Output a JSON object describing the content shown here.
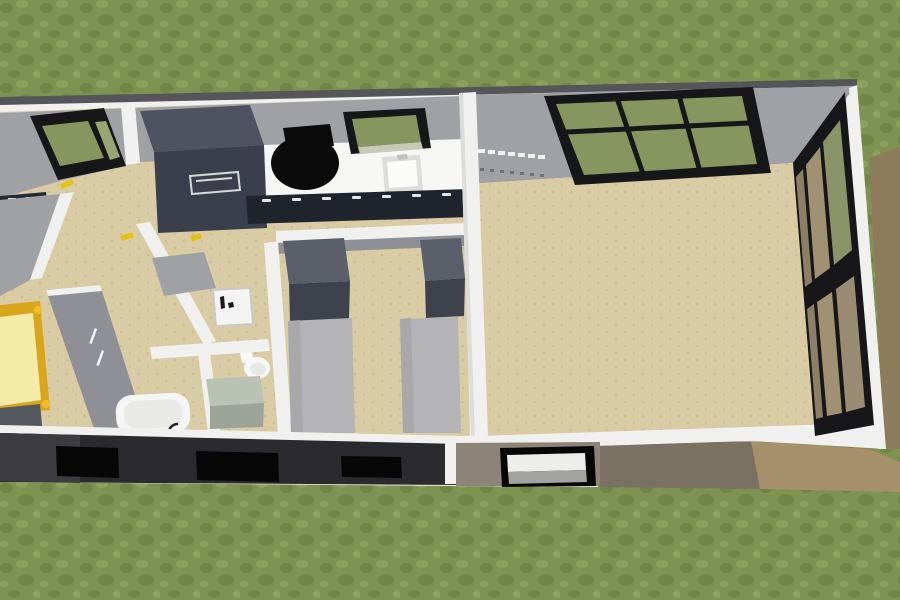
{
  "scene": {
    "type": "3d-floor-plan-render",
    "view": "aerial-perspective",
    "description": "Aerial 3D render of a rectangular single-storey house on a grass lawn with a wooden deck along the right side",
    "canvas": {
      "width": 900,
      "height": 600
    }
  },
  "colors": {
    "grass_base": "#7E9251",
    "grass_dark": "#6F8646",
    "grass_light": "#8BA15C",
    "deck_wood": "#7B7163",
    "deck_wood_light": "#A5906B",
    "deck_wood_side": "#8C7C5C",
    "roof_edge": "#55555A",
    "wall_white": "#F0F0EF",
    "wall_shade": "#DCDCDA",
    "wall_gray": "#9FA1A5",
    "wall_gray_dark": "#8F9095",
    "floor_tan": "#D9CCA4",
    "floor_dot": "#CBBD94",
    "frame_black": "#17171A",
    "glass_green": "#87955E",
    "glass_green_light": "#98A671",
    "glass_sill": "#C6C9B4",
    "counter_white": "#F6F6F5",
    "cabinet_top": "#4E5361",
    "cabinet_front": "#3A3F4B",
    "cabinet_base": "#20242C",
    "cabinet_base_left": "#262A32",
    "handle_white": "#E6E6E6",
    "chair_black": "#0B0B0C",
    "appliance_white": "#F4F4F3",
    "appliance_mark": "#1A1A1A",
    "bed_gray": "#B4B4B6",
    "bed_gray_shade": "#A8A8AA",
    "wardrobe_top": "#5A5F6A",
    "wardrobe_front": "#3D424D",
    "mattress_yellow": "#F4EBA9",
    "frame_gold": "#D9A61B",
    "knob_gold": "#EFBD2A",
    "block_gray": "#55575F",
    "tub_white": "#F5F5F4",
    "tub_inner": "#E9E9E7",
    "toilet_white": "#F7F7F6",
    "toilet_inner": "#E7E7E5",
    "vanity_top": "#BAC2B6",
    "vanity_front": "#9CA49A",
    "front_wall_dark": "#2B2B2F",
    "front_wall_dark_light": "#3C3C40",
    "front_wall_tan": "#8D8478",
    "window_void": "#070708",
    "pane_white": "#EDEDEB",
    "pane_gray": "#A3A3A1",
    "handle_yellow": "#E3C216",
    "mark_white": "#F2F2F2",
    "mark_dark": "#6E7074",
    "glass_wood": "#A09173",
    "glass_wood_mid": "#9A8C72",
    "glass_wood_dark": "#8D7F66",
    "glass_wood_top": "#8A9468"
  },
  "rooms": [
    {
      "id": "lawn",
      "label": "grass lawn"
    },
    {
      "id": "deck",
      "label": "wooden side deck"
    },
    {
      "id": "kitchen",
      "label": "kitchen with counter and sink"
    },
    {
      "id": "hallway",
      "label": "hallway"
    },
    {
      "id": "bedroom-left",
      "label": "bedroom with yellow bed"
    },
    {
      "id": "laundry",
      "label": "laundry nook"
    },
    {
      "id": "bathroom",
      "label": "bathroom"
    },
    {
      "id": "bedroom-middle",
      "label": "bedroom with two single beds"
    },
    {
      "id": "living-room",
      "label": "open living room"
    }
  ],
  "furniture": [
    {
      "id": "back-window-left",
      "label": "corner window, black frame"
    },
    {
      "id": "tall-cabinet",
      "label": "dark tall kitchen unit / fridge"
    },
    {
      "id": "desk-chair",
      "label": "black office chair"
    },
    {
      "id": "sink-window",
      "label": "window above kitchen sink"
    },
    {
      "id": "kitchen-sink",
      "label": "kitchen sink"
    },
    {
      "id": "kitchen-counter",
      "label": "white worktop"
    },
    {
      "id": "base-cabinets",
      "label": "dark base cabinets with handles"
    },
    {
      "id": "big-back-window",
      "label": "large gridded back window"
    },
    {
      "id": "glass-wall",
      "label": "floor-to-ceiling glazed wall to deck"
    },
    {
      "id": "front-windows",
      "label": "three dark front windows"
    },
    {
      "id": "front-window-white",
      "label": "front window with light panes"
    },
    {
      "id": "washing-machine",
      "label": "washing machine"
    },
    {
      "id": "toilet",
      "label": "toilet"
    },
    {
      "id": "vanity",
      "label": "bathroom vanity"
    },
    {
      "id": "bathtub",
      "label": "bathtub"
    },
    {
      "id": "yellow-bed",
      "label": "single bed with gold frame"
    },
    {
      "id": "dresser-block",
      "label": "gray chest at bed foot"
    },
    {
      "id": "wardrobe-1",
      "label": "dark wardrobe"
    },
    {
      "id": "wardrobe-2",
      "label": "dark wardrobe"
    },
    {
      "id": "bed-1",
      "label": "gray single bed"
    },
    {
      "id": "bed-2",
      "label": "gray single bed"
    },
    {
      "id": "door-handles",
      "label": "yellow door handles"
    }
  ]
}
